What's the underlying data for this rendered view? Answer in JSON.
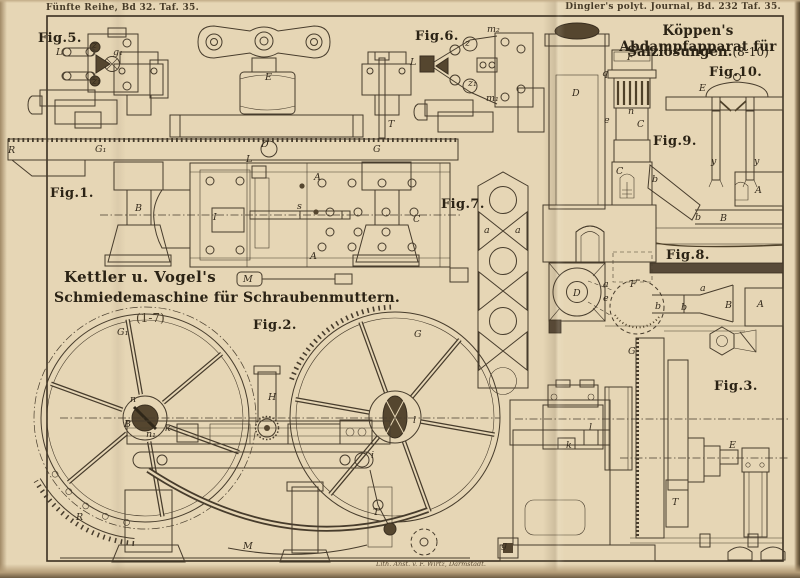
{
  "headers": {
    "left": "Fünfte Reihe, Bd 32. Taf. 35.",
    "right": "Dingler's polyt. Journal, Bd. 232 Taf. 35."
  },
  "plate": {
    "credit": "Lith. Anst. v. F. Wirtz, Darmstadt."
  },
  "titles": {
    "left1": "Kettler u. Vogel's",
    "left2": "Schmiedemaschine für Schraubenmuttern.",
    "left_range": "(1-7)",
    "right1": "Köppen's Abdampfapparat für",
    "right2": "Salzlösungen.",
    "right_range": "(8-10)"
  },
  "figures": {
    "fig1": {
      "label": "Fig.1.",
      "parts": [
        {
          "t": "R",
          "x": 8,
          "y": 153
        },
        {
          "t": "G₁",
          "x": 95,
          "y": 152
        },
        {
          "t": "D",
          "x": 261,
          "y": 147
        },
        {
          "t": "G",
          "x": 373,
          "y": 152
        },
        {
          "t": "T",
          "x": 388,
          "y": 127
        },
        {
          "t": "E",
          "x": 265,
          "y": 80
        },
        {
          "t": "B",
          "x": 135,
          "y": 211
        },
        {
          "t": "C",
          "x": 413,
          "y": 222
        },
        {
          "t": "A",
          "x": 314,
          "y": 180
        },
        {
          "t": "A",
          "x": 310,
          "y": 259
        },
        {
          "t": "L",
          "x": 246,
          "y": 162
        },
        {
          "t": "I",
          "x": 213,
          "y": 220
        },
        {
          "t": "s",
          "x": 297,
          "y": 209
        },
        {
          "t": "M",
          "x": 243,
          "y": 282
        }
      ]
    },
    "fig2": {
      "label": "Fig.2.",
      "parts": [
        {
          "t": "G₁",
          "x": 117,
          "y": 335,
          "s": 12
        },
        {
          "t": "G",
          "x": 414,
          "y": 337,
          "s": 12
        },
        {
          "t": "B",
          "x": 124,
          "y": 427
        },
        {
          "t": "n",
          "x": 130,
          "y": 402
        },
        {
          "t": "n₁",
          "x": 146,
          "y": 437
        },
        {
          "t": "k",
          "x": 165,
          "y": 431
        },
        {
          "t": "H",
          "x": 268,
          "y": 400
        },
        {
          "t": "R",
          "x": 76,
          "y": 520
        },
        {
          "t": "M",
          "x": 243,
          "y": 549
        },
        {
          "t": "T",
          "x": 373,
          "y": 515
        },
        {
          "t": "i",
          "x": 371,
          "y": 458
        },
        {
          "t": "l",
          "x": 413,
          "y": 423
        }
      ]
    },
    "fig3": {
      "label": "Fig.3.",
      "parts": [
        {
          "t": "G",
          "x": 628,
          "y": 354
        },
        {
          "t": "T",
          "x": 672,
          "y": 505
        },
        {
          "t": "E",
          "x": 729,
          "y": 448
        },
        {
          "t": "k",
          "x": 566,
          "y": 448
        },
        {
          "t": "l",
          "x": 589,
          "y": 430
        },
        {
          "t": "g",
          "x": 501,
          "y": 548
        }
      ]
    },
    "fig5": {
      "label": "Fig.5.",
      "parts": [
        {
          "t": "L",
          "x": 56,
          "y": 55
        },
        {
          "t": "z",
          "x": 92,
          "y": 48
        },
        {
          "t": "z₁",
          "x": 92,
          "y": 84
        },
        {
          "t": "g₁",
          "x": 113,
          "y": 55
        }
      ]
    },
    "fig6": {
      "label": "Fig.6.",
      "parts": [
        {
          "t": "L",
          "x": 410,
          "y": 65
        },
        {
          "t": "z",
          "x": 465,
          "y": 46
        },
        {
          "t": "z₁",
          "x": 468,
          "y": 86
        },
        {
          "t": "m₂",
          "x": 487,
          "y": 32
        },
        {
          "t": "m₁",
          "x": 486,
          "y": 101
        }
      ]
    },
    "fig7": {
      "label": "Fig.7.",
      "parts": [
        {
          "t": "a",
          "x": 484,
          "y": 233
        },
        {
          "t": "a",
          "x": 515,
          "y": 233
        }
      ]
    },
    "fig8": {
      "label": "Fig.8.",
      "parts": [
        {
          "t": "D",
          "x": 573,
          "y": 296
        },
        {
          "t": "F",
          "x": 630,
          "y": 287
        },
        {
          "t": "a",
          "x": 603,
          "y": 287
        },
        {
          "t": "e",
          "x": 603,
          "y": 301
        },
        {
          "t": "b",
          "x": 655,
          "y": 309
        },
        {
          "t": "b",
          "x": 681,
          "y": 310
        },
        {
          "t": "a",
          "x": 700,
          "y": 291
        },
        {
          "t": "B",
          "x": 725,
          "y": 308
        },
        {
          "t": "A",
          "x": 757,
          "y": 307
        }
      ]
    },
    "fig9": {
      "label": "Fig.9.",
      "parts": [
        {
          "t": "D",
          "x": 572,
          "y": 96
        },
        {
          "t": "e",
          "x": 604,
          "y": 123
        },
        {
          "t": "F",
          "x": 627,
          "y": 60
        },
        {
          "t": "q",
          "x": 602,
          "y": 76
        },
        {
          "t": "n",
          "x": 628,
          "y": 114
        },
        {
          "t": "C",
          "x": 637,
          "y": 127
        },
        {
          "t": "C",
          "x": 616,
          "y": 174
        },
        {
          "t": "b",
          "x": 652,
          "y": 182
        },
        {
          "t": "b",
          "x": 695,
          "y": 220
        },
        {
          "t": "B",
          "x": 720,
          "y": 221
        },
        {
          "t": "A",
          "x": 755,
          "y": 193
        }
      ]
    },
    "fig10": {
      "label": "Fig.10.",
      "parts": [
        {
          "t": "E",
          "x": 699,
          "y": 91
        },
        {
          "t": "y",
          "x": 711,
          "y": 164
        },
        {
          "t": "y",
          "x": 754,
          "y": 164
        }
      ]
    }
  }
}
